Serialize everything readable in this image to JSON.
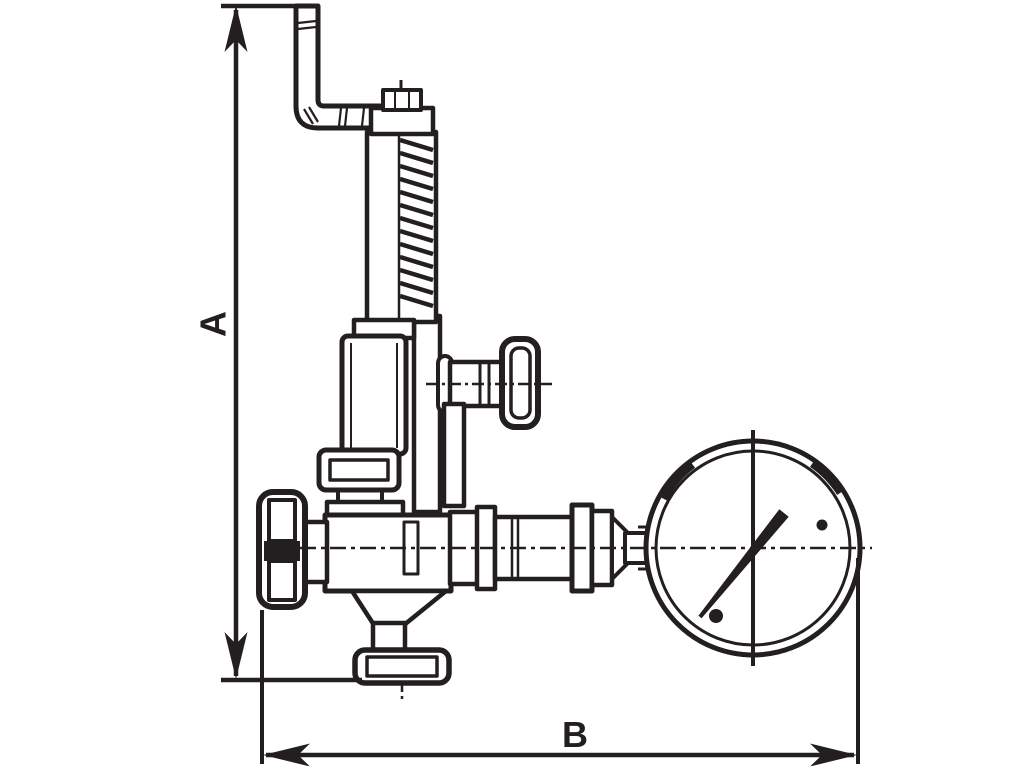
{
  "drawing": {
    "type": "technical-line-drawing",
    "subject": "pressure reducing valve with gauge, side elevation with overall dimensions",
    "colors": {
      "ink": "#231F20",
      "background": "#FFFFFF"
    },
    "dimension_a": {
      "label": "A",
      "orientation": "vertical",
      "measures": "overall height from top of bent lever pipe to bottom outlet flange"
    },
    "dimension_b": {
      "label": "B",
      "orientation": "horizontal",
      "measures": "overall width from left handwheel to right edge of pressure gauge"
    },
    "parts": [
      "bent-lever-pipe",
      "adjusting-nut",
      "spring-column",
      "spring-housing",
      "side-shutoff-valve-knob",
      "bonnet-flange",
      "valve-body",
      "left-handwheel",
      "bottom-outlet-flange",
      "pipe-union",
      "pressure-gauge",
      "gauge-needle"
    ]
  }
}
